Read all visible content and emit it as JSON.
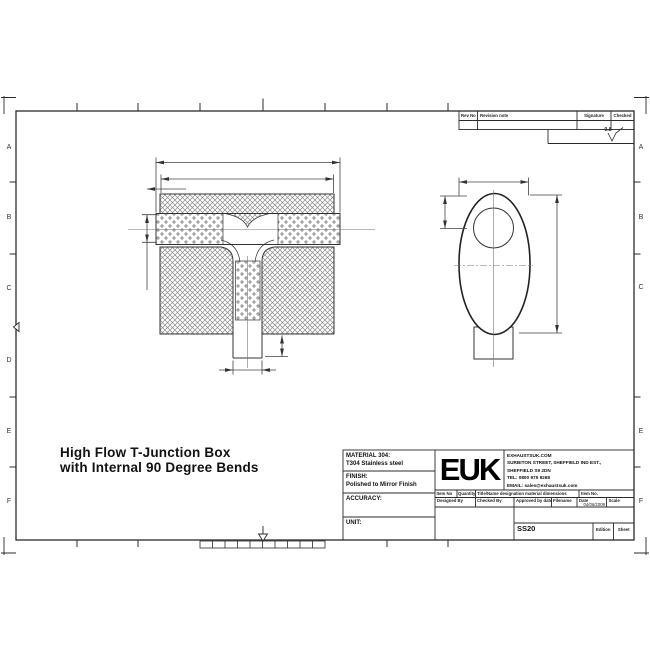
{
  "sheet": {
    "zones_left": [
      "A",
      "B",
      "C",
      "D",
      "E",
      "F"
    ],
    "zones_right": [
      "A",
      "B",
      "C",
      "E",
      "F"
    ]
  },
  "revision_table": {
    "col_rev_no": "Rev No",
    "col_note": "Revision note",
    "col_signature": "Signature",
    "col_checked": "Checked"
  },
  "surface_finish": {
    "value": "0.8"
  },
  "title_note": {
    "line1": "High Flow T-Junction Box",
    "line2": "with Internal 90 Degree Bends"
  },
  "title_block": {
    "material_label": "MATERIAL 304:",
    "material_value": "T304 Stainless steel",
    "finish_label": "FINISH:",
    "finish_value": "Polished to Mirror Finish",
    "accuracy_label": "ACCURACY:",
    "unit_label": "UNIT:",
    "logo": "EUK",
    "address": {
      "line1": "EXHAUSTSUK.COM",
      "line2": "SURBITON STREET, SHEFFIELD IND EST.,",
      "line3": "SHEFFIELD S9 2DN",
      "line4": "TEL: 0800 975 9268",
      "line5": "EMAIL: sales@exhaustsuk.com"
    },
    "item_row": {
      "item_no": "Item No",
      "quantity": "Quantity",
      "designation": "Title/Name designation material dimensions",
      "item_no2": "Item No."
    },
    "sign_row": {
      "designed": "Designed By",
      "checked": "Checked By",
      "approved": "Approved by date",
      "filename": "Filename",
      "date": "Date",
      "scale": "Scale"
    },
    "date_value": "04/06/2009",
    "part_number": "SS20",
    "edition_label": "Edition",
    "sheet_label": "Sheet"
  }
}
